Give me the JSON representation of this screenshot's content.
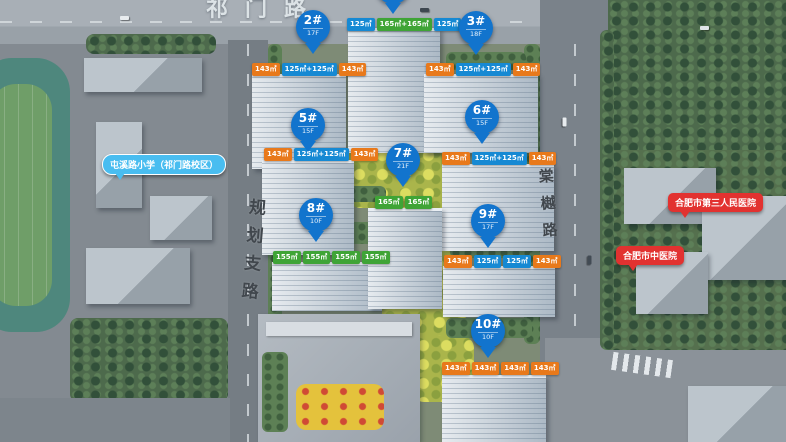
{
  "colors": {
    "pin_blue": "#1274cd",
    "tag_blue": "#1689d3",
    "tag_green": "#3fa436",
    "tag_orange": "#e8791b",
    "school_bubble": "#49bdf0",
    "hospital_bubble": "#e23230"
  },
  "roads": {
    "top": "祁门路",
    "left": "规划支路",
    "right": "棠樾路"
  },
  "pois": {
    "school": "屯溪路小学（祁门路校区）",
    "hospital_1": "合肥市第三人民医院",
    "hospital_2": "合肥市中医院"
  },
  "buildings": {
    "b1": {
      "tags": [
        {
          "text": "125㎡"
        },
        {
          "text": "165㎡+165㎡"
        },
        {
          "text": "125㎡"
        }
      ]
    },
    "b2": {
      "marker": "2#",
      "floors": "17F",
      "tags": [
        {
          "text": "143㎡"
        },
        {
          "text": "125㎡+125㎡"
        },
        {
          "text": "143㎡"
        }
      ]
    },
    "b3": {
      "marker": "3#",
      "floors": "18F",
      "tags": [
        {
          "text": "143㎡"
        },
        {
          "text": "125㎡+125㎡"
        },
        {
          "text": "143㎡"
        }
      ]
    },
    "b5": {
      "marker": "5#",
      "floors": "15F",
      "tags": [
        {
          "text": "143㎡"
        },
        {
          "text": "125㎡+125㎡"
        },
        {
          "text": "143㎡"
        }
      ]
    },
    "b6": {
      "marker": "6#",
      "floors": "15F",
      "tags": [
        {
          "text": "143㎡"
        },
        {
          "text": "125㎡+125㎡"
        },
        {
          "text": "143㎡"
        }
      ]
    },
    "b7": {
      "marker": "7#",
      "floors": "21F",
      "tags": [
        {
          "text": "165㎡"
        },
        {
          "text": "165㎡"
        }
      ]
    },
    "b8": {
      "marker": "8#",
      "floors": "10F",
      "tags": [
        {
          "text": "155㎡"
        },
        {
          "text": "155㎡"
        },
        {
          "text": "155㎡"
        },
        {
          "text": "155㎡"
        }
      ]
    },
    "b9": {
      "marker": "9#",
      "floors": "17F",
      "tags": [
        {
          "text": "143㎡"
        },
        {
          "text": "125㎡"
        },
        {
          "text": "125㎡"
        },
        {
          "text": "143㎡"
        }
      ]
    },
    "b10": {
      "marker": "10#",
      "floors": "10F",
      "tags": [
        {
          "text": "143㎡"
        },
        {
          "text": "143㎡"
        },
        {
          "text": "143㎡"
        },
        {
          "text": "143㎡"
        }
      ]
    }
  }
}
